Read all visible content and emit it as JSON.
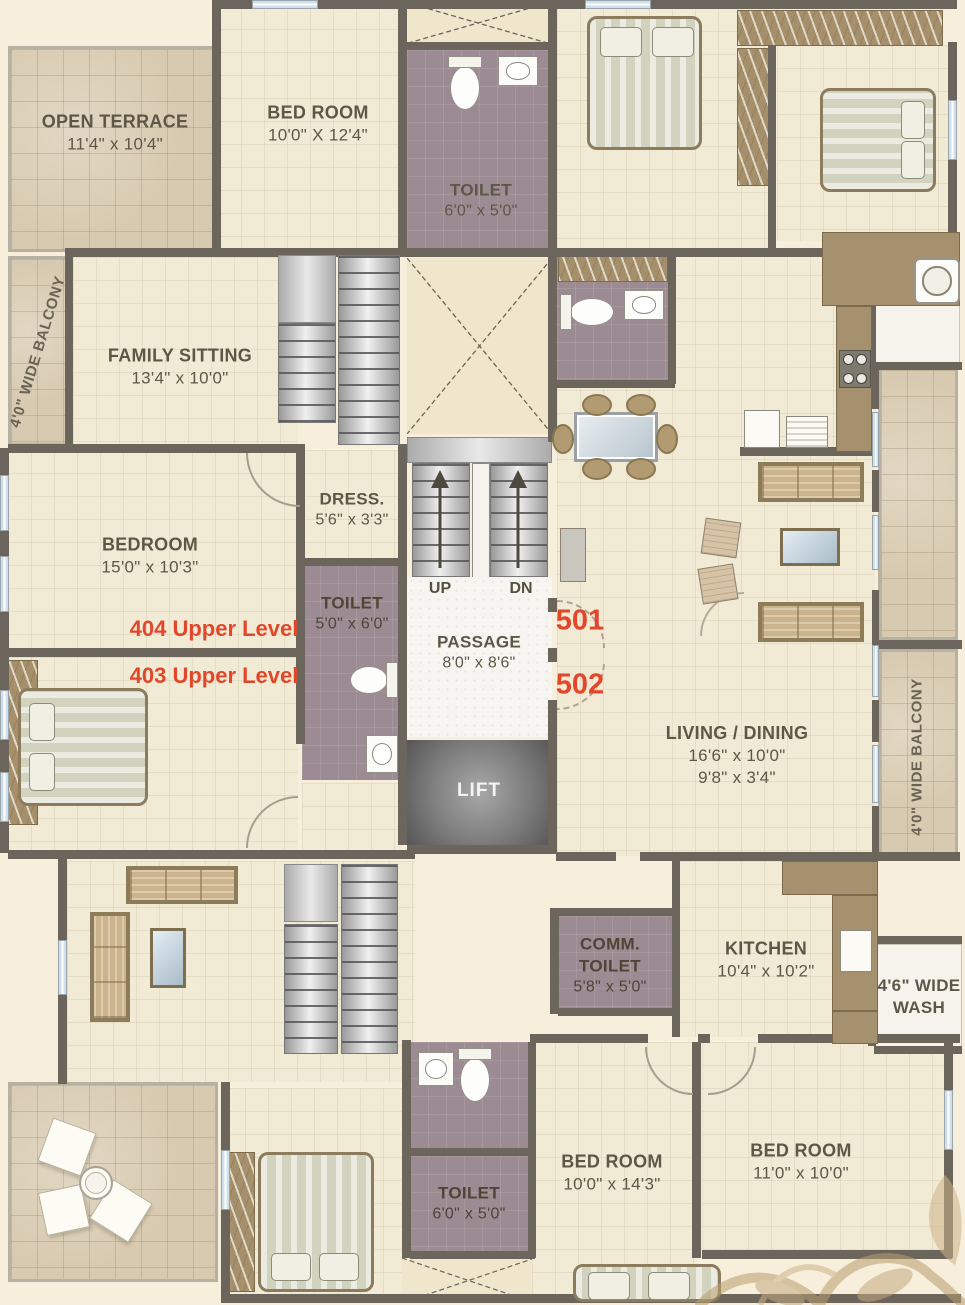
{
  "plan": {
    "type": "residential-floor-plan",
    "colors": {
      "paper": "#f7efdc",
      "room_floor": "#f1ead5",
      "terrace_floor": "#d8cab0",
      "toilet_floor": "#9c8b92",
      "wall": "#6b655b",
      "wood": "#a6916e",
      "accent_red": "#e2472b"
    },
    "rooms": {
      "open_terrace": {
        "name": "OPEN TERRACE",
        "dim": "11'4\" x 10'4\""
      },
      "balcony_left": {
        "name": "4'0\" WIDE BALCONY"
      },
      "bed_top": {
        "name": "BED ROOM",
        "dim": "10'0\" X 12'4\""
      },
      "toilet_top": {
        "name": "TOILET",
        "dim": "6'0\" x 5'0\""
      },
      "family_sitting": {
        "name": "FAMILY SITTING",
        "dim": "13'4\" x 10'0\""
      },
      "dress": {
        "name": "DRESS.",
        "dim": "5'6\" x 3'3\""
      },
      "bedroom_left": {
        "name": "BEDROOM",
        "dim": "15'0\" x 10'3\""
      },
      "toilet_mid": {
        "name": "TOILET",
        "dim": "5'0\" x 6'0\""
      },
      "passage": {
        "name": "PASSAGE",
        "dim": "8'0\" x 8'6\""
      },
      "lift": {
        "name": "LIFT"
      },
      "living_dining": {
        "name": "LIVING / DINING",
        "dim": "16'6\" x 10'0\"",
        "dim2": "9'8\" x 3'4\""
      },
      "comm_toilet": {
        "name1": "COMM.",
        "name2": "TOILET",
        "dim": "5'8\" x 5'0\""
      },
      "kitchen": {
        "name": "KITCHEN",
        "dim": "10'4\" x 10'2\""
      },
      "wash": {
        "name1": "4'6\" WIDE",
        "name2": "WASH"
      },
      "balcony_right": {
        "name": "4'0\" WIDE BALCONY"
      },
      "toilet_bottom": {
        "name": "TOILET",
        "dim": "6'0\" x 5'0\""
      },
      "bed_bottom_mid": {
        "name": "BED ROOM",
        "dim": "10'0\" x 14'3\""
      },
      "bed_bottom_right": {
        "name": "BED ROOM",
        "dim": "11'0\" x 10'0\""
      }
    },
    "annotations": {
      "unit_501": "501",
      "unit_502": "502",
      "level_404": "404 Upper Level",
      "level_403": "403 Upper Level",
      "stairs_up": "UP",
      "stairs_dn": "DN"
    }
  }
}
